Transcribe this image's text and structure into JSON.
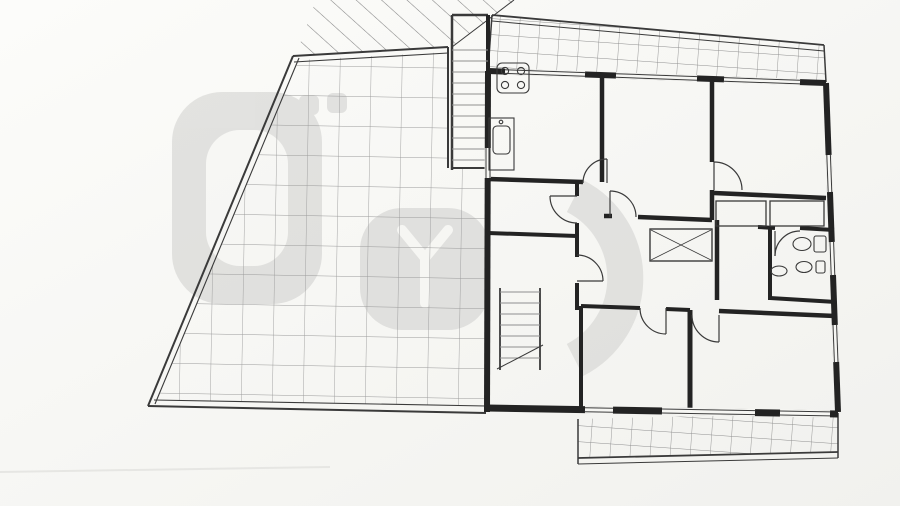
{
  "watermark": {
    "brand": "Prestyge"
  },
  "rooms": {
    "escada3": {
      "name": "Escada3",
      "area": "1.90m2"
    },
    "varanda1": {
      "name": "Varanda1",
      "area": "11.50m2"
    },
    "cozinha": {
      "name": "Cozinha",
      "area": "10.54m2"
    },
    "sala_comum": {
      "name": "Sala Comum",
      "area": "13.80m2"
    },
    "quarto1": {
      "name": "Quarto 1",
      "area": "10.20m2"
    },
    "despensa": {
      "name": "Despensa",
      "area": "2.80m2"
    },
    "hall3": {
      "name": "Hall 3",
      "area": "7.30m2"
    },
    "circulacao": {
      "name": "Circulação",
      "area": "13.27m2"
    },
    "wc3": {
      "name": "WC 3",
      "area": "3.84m2"
    },
    "escritorio": {
      "name": "Escritório",
      "area": "9.45m2"
    },
    "quarto2": {
      "name": "Quarto 2",
      "area": "13.95m2"
    },
    "varanda2": {
      "name": "Varanda2",
      "area": "6.35m2"
    }
  },
  "colors": {
    "line": "#232323",
    "paper": "#f6f6f3",
    "grid": "#9a9a9a",
    "watermark": "#cfcfcd"
  },
  "dimensions": {
    "labels": [
      {
        "t": "3.10",
        "x": 554,
        "y": 76
      },
      {
        "t": "0.15",
        "x": 603,
        "y": 80
      },
      {
        "t": "3.10",
        "x": 660,
        "y": 85
      },
      {
        "t": "0.15",
        "x": 712,
        "y": 90
      },
      {
        "t": "3.00",
        "x": 763,
        "y": 95
      },
      {
        "t": "0.25",
        "x": 814,
        "y": 97
      },
      {
        "t": "8.35",
        "x": 670,
        "y": 28
      },
      {
        "t": "0.10",
        "x": 733,
        "y": 12,
        "r": -90
      },
      {
        "t": "1.30",
        "x": 736,
        "y": 46,
        "r": -90
      },
      {
        "t": "0.25",
        "x": 509,
        "y": 16,
        "r": -90
      },
      {
        "t": "1.00",
        "x": 509,
        "y": 38,
        "r": -90
      },
      {
        "t": "0.10",
        "x": 833,
        "y": 39
      },
      {
        "t": "1.40",
        "x": 849,
        "y": 52,
        "r": -90
      },
      {
        "t": "4.20",
        "x": 429,
        "y": 82,
        "r": -90
      },
      {
        "t": "0.25",
        "x": 449,
        "y": 110
      },
      {
        "t": "0.90",
        "x": 471,
        "y": 111
      },
      {
        "t": "1.15",
        "x": 467,
        "y": 164
      },
      {
        "t": "3.40",
        "x": 517,
        "y": 115,
        "r": -90
      },
      {
        "t": "1.40",
        "x": 505,
        "y": 208,
        "r": -90
      },
      {
        "t": "0.25",
        "x": 500,
        "y": 234,
        "r": -90
      },
      {
        "t": "7.42",
        "x": 458,
        "y": 287,
        "r": -90
      },
      {
        "t": "4.75",
        "x": 514,
        "y": 331,
        "r": -90
      },
      {
        "t": "0.25",
        "x": 506,
        "y": 421,
        "r": -90
      },
      {
        "t": "4.45",
        "x": 635,
        "y": 142,
        "r": -90
      },
      {
        "t": "0.15",
        "x": 626,
        "y": 224,
        "r": -90
      },
      {
        "t": "2.00",
        "x": 637,
        "y": 266,
        "r": -90
      },
      {
        "t": "0.15",
        "x": 628,
        "y": 298,
        "r": -90
      },
      {
        "t": "3.15",
        "x": 639,
        "y": 358,
        "r": -90
      },
      {
        "t": "3.40",
        "x": 793,
        "y": 135,
        "r": -90
      },
      {
        "t": "0.80",
        "x": 702,
        "y": 245,
        "r": -90
      },
      {
        "t": "1.20",
        "x": 704,
        "y": 275,
        "r": -90
      },
      {
        "t": "3.60",
        "x": 801,
        "y": 352,
        "r": -90
      },
      {
        "t": "2.00",
        "x": 538,
        "y": 226
      },
      {
        "t": "0.65",
        "x": 572,
        "y": 224
      },
      {
        "t": "0.15",
        "x": 703,
        "y": 208
      },
      {
        "t": "1.25",
        "x": 741,
        "y": 208
      },
      {
        "t": "0.15",
        "x": 759,
        "y": 211
      },
      {
        "t": "1.60",
        "x": 790,
        "y": 213
      },
      {
        "t": "0.25",
        "x": 493,
        "y": 392
      },
      {
        "t": "2.00",
        "x": 537,
        "y": 393
      },
      {
        "t": "0.25",
        "x": 577,
        "y": 392
      },
      {
        "t": "3.00",
        "x": 634,
        "y": 394
      },
      {
        "t": "0.15",
        "x": 687,
        "y": 397
      },
      {
        "t": "4.10",
        "x": 757,
        "y": 397
      },
      {
        "t": "0.25",
        "x": 827,
        "y": 397
      },
      {
        "t": "0.10",
        "x": 570,
        "y": 445
      },
      {
        "t": "0.90",
        "x": 624,
        "y": 438,
        "r": -90
      },
      {
        "t": "0.10",
        "x": 624,
        "y": 466,
        "r": -90
      },
      {
        "t": "7.05",
        "x": 708,
        "y": 444
      },
      {
        "t": "0.10",
        "x": 839,
        "y": 445
      },
      {
        "t": "2.10",
        "x": 862,
        "y": 106,
        "r": -90
      },
      {
        "t": "1.10",
        "x": 863,
        "y": 160,
        "r": -90
      },
      {
        "t": "1.50",
        "x": 864,
        "y": 203,
        "r": -90
      },
      {
        "t": "1.00",
        "x": 865,
        "y": 249,
        "r": -90
      },
      {
        "t": "1.50",
        "x": 866,
        "y": 291,
        "r": -90
      },
      {
        "t": "1.10",
        "x": 867,
        "y": 333,
        "r": -90
      },
      {
        "t": "2.10",
        "x": 868,
        "y": 391,
        "r": -90
      },
      {
        "t": "10.40",
        "x": 882,
        "y": 250,
        "r": -90
      },
      {
        "t": "1.00",
        "x": 896,
        "y": 452,
        "r": -90
      },
      {
        "t": "0.80",
        "x": 507,
        "y": 508
      },
      {
        "t": "0.90",
        "x": 538,
        "y": 508
      },
      {
        "t": "1.55",
        "x": 583,
        "y": 508
      },
      {
        "t": "1.40",
        "x": 639,
        "y": 508
      },
      {
        "t": "2.95",
        "x": 711,
        "y": 508
      },
      {
        "t": "1.40",
        "x": 785,
        "y": 508
      },
      {
        "t": "1.00",
        "x": 824,
        "y": 508
      }
    ],
    "lines": [
      [
        490,
        78,
        826,
        95
      ],
      [
        855,
        86,
        858,
        433
      ],
      [
        872,
        84,
        875,
        433
      ],
      [
        846,
        30,
        846,
        76
      ],
      [
        488,
        502,
        845,
        494
      ],
      [
        492,
        486,
        492,
        503
      ],
      [
        522,
        486,
        522,
        503
      ],
      [
        557,
        486,
        557,
        503
      ],
      [
        613,
        486,
        613,
        503
      ],
      [
        663,
        486,
        663,
        503
      ],
      [
        760,
        486,
        760,
        503
      ],
      [
        808,
        486,
        808,
        503
      ],
      [
        840,
        486,
        840,
        503
      ],
      [
        437,
        42,
        437,
        122
      ],
      [
        443,
        115,
        492,
        113
      ],
      [
        450,
        170,
        492,
        168
      ],
      [
        464,
        175,
        464,
        418
      ],
      [
        521,
        78,
        521,
        180
      ],
      [
        630,
        80,
        630,
        218
      ],
      [
        797,
        98,
        797,
        192
      ],
      [
        509,
        183,
        509,
        240
      ],
      [
        519,
        288,
        519,
        370
      ],
      [
        632,
        215,
        632,
        300
      ],
      [
        643,
        308,
        643,
        400
      ],
      [
        706,
        228,
        706,
        298
      ],
      [
        805,
        318,
        805,
        402
      ],
      [
        490,
        230,
        590,
        228
      ],
      [
        695,
        212,
        832,
        218
      ],
      [
        488,
        396,
        838,
        403
      ],
      [
        568,
        448,
        840,
        442
      ],
      [
        619,
        420,
        619,
        472
      ],
      [
        495,
        25,
        826,
        48
      ],
      [
        886,
        430,
        886,
        470
      ],
      [
        733,
        5,
        733,
        22
      ]
    ],
    "ticks": [
      [
        490,
        78
      ],
      [
        600,
        84
      ],
      [
        608,
        84
      ],
      [
        706,
        89
      ],
      [
        715,
        90
      ],
      [
        806,
        94
      ],
      [
        826,
        95
      ],
      [
        855,
        86
      ],
      [
        856,
        155
      ],
      [
        856,
        192
      ],
      [
        857,
        242
      ],
      [
        857,
        275
      ],
      [
        858,
        325
      ],
      [
        858,
        362
      ],
      [
        858,
        433
      ],
      [
        872,
        84
      ],
      [
        875,
        433
      ],
      [
        846,
        30
      ],
      [
        846,
        76
      ],
      [
        437,
        42
      ],
      [
        437,
        122
      ],
      [
        443,
        115
      ],
      [
        452,
        115
      ],
      [
        483,
        114
      ],
      [
        450,
        170
      ],
      [
        490,
        168
      ],
      [
        464,
        175
      ],
      [
        464,
        418
      ],
      [
        521,
        78
      ],
      [
        521,
        180
      ],
      [
        630,
        80
      ],
      [
        630,
        218
      ],
      [
        797,
        98
      ],
      [
        797,
        192
      ],
      [
        509,
        183
      ],
      [
        509,
        231
      ],
      [
        509,
        240
      ],
      [
        519,
        288
      ],
      [
        519,
        370
      ],
      [
        632,
        218
      ],
      [
        632,
        223
      ],
      [
        632,
        291
      ],
      [
        632,
        296
      ],
      [
        643,
        308
      ],
      [
        643,
        400
      ],
      [
        706,
        228
      ],
      [
        706,
        255
      ],
      [
        706,
        296
      ],
      [
        805,
        318
      ],
      [
        805,
        402
      ],
      [
        490,
        230
      ],
      [
        498,
        230
      ],
      [
        566,
        229
      ],
      [
        588,
        228
      ],
      [
        695,
        212
      ],
      [
        700,
        212
      ],
      [
        743,
        214
      ],
      [
        748,
        214
      ],
      [
        803,
        217
      ],
      [
        830,
        218
      ],
      [
        488,
        396
      ],
      [
        496,
        396
      ],
      [
        564,
        398
      ],
      [
        573,
        398
      ],
      [
        675,
        400
      ],
      [
        680,
        400
      ],
      [
        820,
        402
      ],
      [
        829,
        403
      ],
      [
        570,
        448
      ],
      [
        578,
        448
      ],
      [
        818,
        443
      ],
      [
        828,
        442
      ],
      [
        619,
        420
      ],
      [
        619,
        451
      ],
      [
        619,
        458
      ],
      [
        495,
        25
      ],
      [
        826,
        48
      ],
      [
        886,
        430
      ],
      [
        886,
        464
      ],
      [
        492,
        502
      ],
      [
        522,
        501
      ],
      [
        557,
        500
      ],
      [
        613,
        499
      ],
      [
        663,
        498
      ],
      [
        760,
        496
      ],
      [
        808,
        495
      ],
      [
        840,
        494
      ]
    ]
  }
}
